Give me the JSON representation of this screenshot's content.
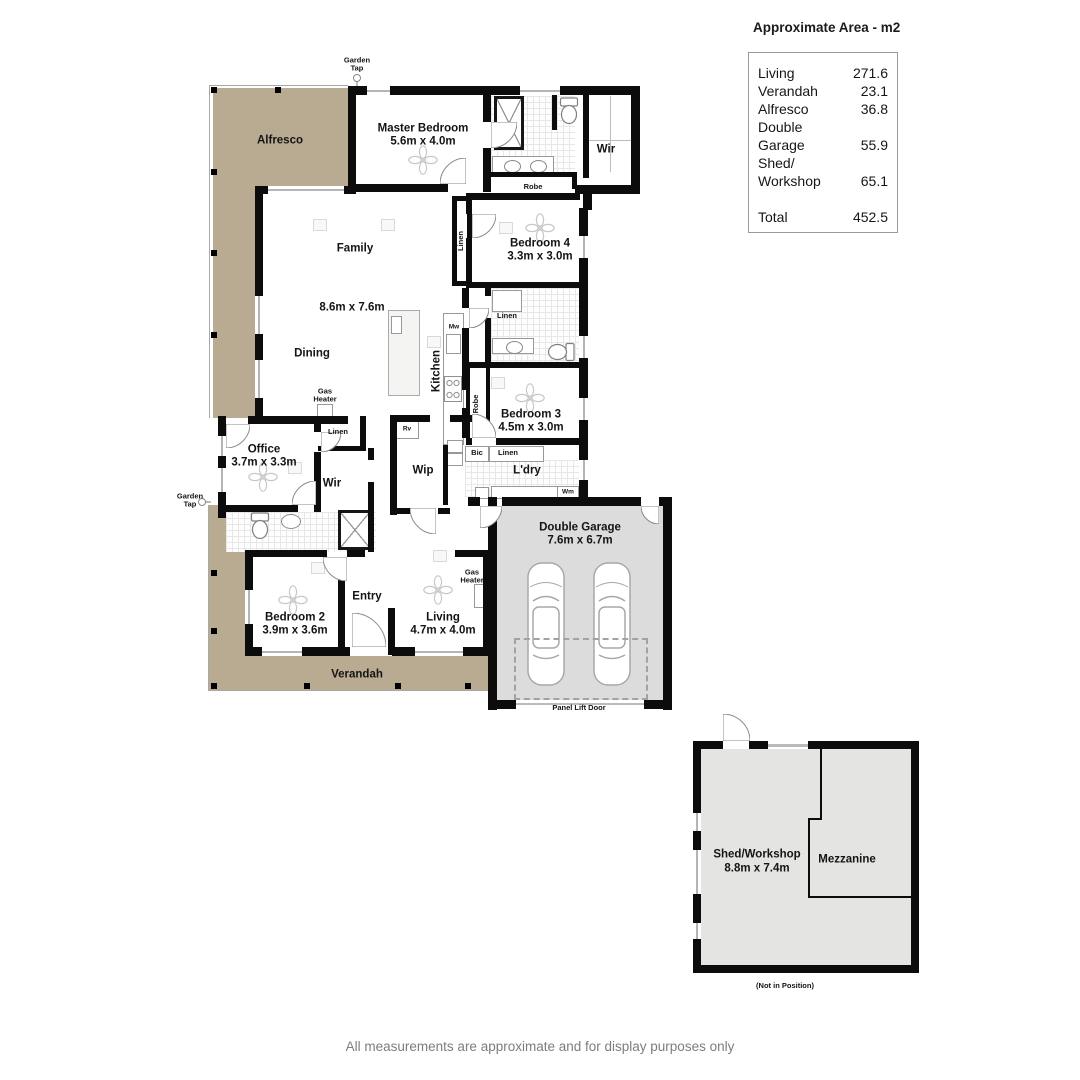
{
  "area_table": {
    "title": "Approximate Area - m2",
    "rows": [
      {
        "label": "Living",
        "value": "271.6"
      },
      {
        "label": "Verandah",
        "value": "23.1"
      },
      {
        "label": "Alfresco",
        "value": "36.8"
      },
      {
        "label": "Double Garage",
        "value": "55.9"
      },
      {
        "label": "Shed/Workshop",
        "value": "65.1"
      },
      {
        "label": "Total",
        "value": "452.5",
        "is_total": true
      }
    ]
  },
  "plan_labels": {
    "alfresco": "Alfresco",
    "master_name": "Master Bedroom",
    "master_dims": "5.6m x 4.0m",
    "wir_ensuite": "Wir",
    "robe_master": "Robe",
    "bedroom4_name": "Bedroom 4",
    "bedroom4_dims": "3.3m x 3.0m",
    "linen_hall": "Linen",
    "family": "Family",
    "open_dims": "8.6m x 7.6m",
    "dining": "Dining",
    "kitchen": "Kitchen",
    "mw": "Mw",
    "gas_heater_family": "Gas Heater",
    "linen_office": "Linen",
    "office_name": "Office",
    "office_dims": "3.7m x 3.3m",
    "wir_office": "Wir",
    "rv": "Rv",
    "wip": "Wip",
    "bic": "Bic",
    "linen_ldry": "Linen",
    "ldry": "L'dry",
    "wm": "Wm",
    "robe_bed3": "Robe",
    "linen_bath2": "Linen",
    "bedroom3_name": "Bedroom 3",
    "bedroom3_dims": "4.5m x 3.0m",
    "entry": "Entry",
    "bedroom2_name": "Bedroom 2",
    "bedroom2_dims": "3.9m x 3.6m",
    "living_name": "Living",
    "living_dims": "4.7m x 4.0m",
    "gas_heater_living": "Gas Heater",
    "verandah": "Verandah",
    "garage_name": "Double Garage",
    "garage_dims": "7.6m x 6.7m",
    "panel_lift_door": "Panel Lift Door",
    "garden_tap_top": "Garden Tap",
    "garden_tap_left": "Garden Tap",
    "shed_name": "Shed/Workshop",
    "shed_dims": "8.8m x 7.4m",
    "mezzanine": "Mezzanine",
    "not_in_position": "(Not in Position)"
  },
  "colors": {
    "alfresco_verandah": "#b8ab92",
    "garage_floor": "#dcdcdc",
    "shed_floor": "#e4e4e2",
    "walls": "#0c0c0c"
  },
  "disclaimer": "All measurements are approximate and for display purposes only"
}
